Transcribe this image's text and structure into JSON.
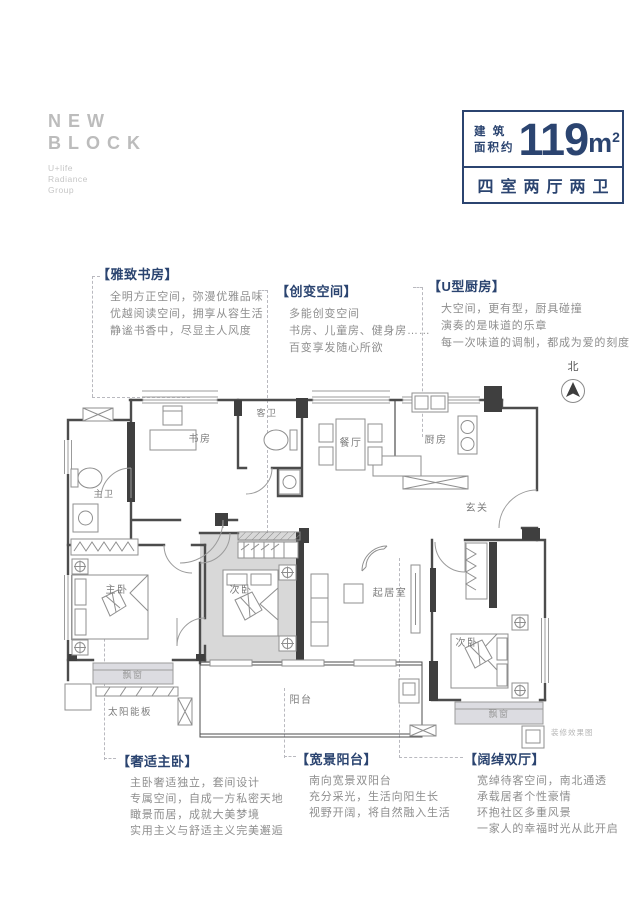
{
  "logo": {
    "name_line1": "NEW",
    "name_line2": "BLOCK",
    "subtitle_lines": [
      "U+life",
      "Radiance",
      "Group"
    ]
  },
  "area_badge": {
    "label_top": "建 筑",
    "label_bottom": "面积约",
    "area_number": "119",
    "area_unit": "m",
    "area_sup": "2",
    "layout": "四室两厅两卫"
  },
  "callouts": {
    "top": [
      {
        "title": "【雅致书房】",
        "lines": [
          "全明方正空间，弥漫优雅品味",
          "优越阅读空间，拥享从容生活",
          "静谧书香中，尽显主人风度"
        ]
      },
      {
        "title": "【创变空间】",
        "lines": [
          "多能创变空间",
          "书房、儿童房、健身房……",
          "百变享发随心所欲"
        ]
      },
      {
        "title": "【U型厨房】",
        "lines": [
          "大空间，更有型，厨具碰撞",
          "演奏的是味道的乐章",
          "每一次味道的调制，都成为爱的刻度"
        ]
      }
    ],
    "bottom": [
      {
        "title": "【奢适主卧】",
        "lines": [
          "主卧奢适独立，套间设计",
          "专属空间，自成一方私密天地",
          "瞰景而居，成就大美梦境",
          "实用主义与舒适主义完美邂逅"
        ]
      },
      {
        "title": "【宽景阳台】",
        "lines": [
          "南向宽景双阳台",
          "充分采光，生活向阳生长",
          "视野开阔，将自然融入生活"
        ]
      },
      {
        "title": "【阔绰双厅】",
        "lines": [
          "宽绰待客空间，南北通透",
          "承载居者个性豪情",
          "环抱社区多重风景",
          "一家人的幸福时光从此开启"
        ]
      }
    ]
  },
  "floorplan": {
    "rooms": {
      "study": "书房",
      "guest_bath": "客卫",
      "dining": "餐厅",
      "kitchen": "厨房",
      "master_bath": "主卫",
      "foyer": "玄关",
      "master_bed": "主卧",
      "bed2": "次卧",
      "living": "起居室",
      "bed3": "次卧",
      "bay1": "飘窗",
      "bay2": "飘窗",
      "balcony": "阳台",
      "solar": "太阳能板"
    },
    "compass": "北",
    "note": "装修效果图"
  },
  "colors": {
    "navy": "#2b4470",
    "body_gray": "#8e8e8e",
    "logo_gray": "#bcbcbc",
    "wall": "#4c4c4c",
    "thin_line": "#9b9b9b",
    "room_shade": "#d8d8d8",
    "bay_shade": "#dcdce1"
  }
}
